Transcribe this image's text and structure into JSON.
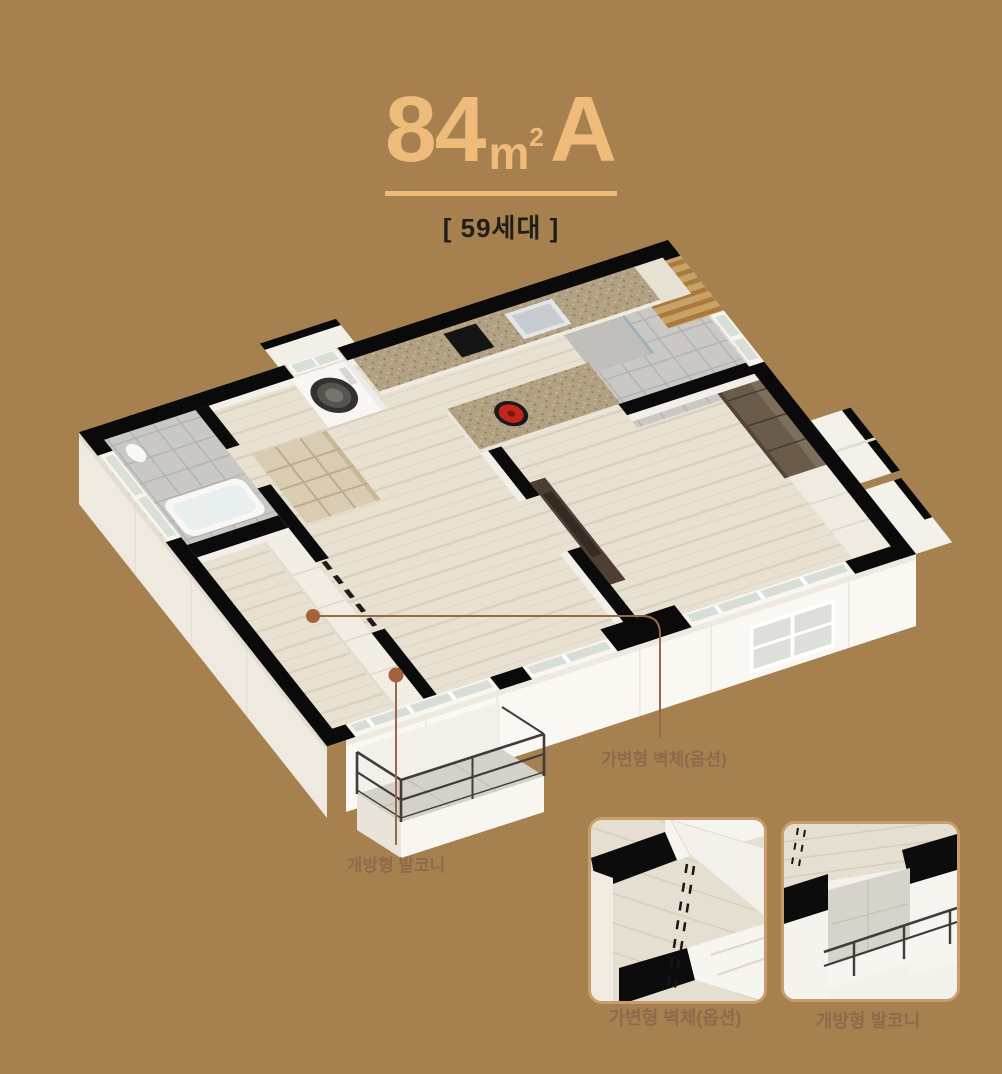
{
  "title": {
    "area": "84",
    "unit": "m",
    "sup": "2",
    "type": "A"
  },
  "households": "[ 59세대 ]",
  "callouts": {
    "wall": "가변형 벽체(옵션)",
    "balcony": "개방형 발코니"
  },
  "insets": [
    {
      "caption": "가변형 벽체(옵션)"
    },
    {
      "caption": "개방형 발코니"
    }
  ],
  "colors": {
    "background": "#A6814F",
    "accent_gold": "#EFBB7B",
    "dark_text": "#201D18",
    "label_brown": "#8D6A4B",
    "leader_line": "#9B6847",
    "leader_dot": "#A3613C",
    "wall_black": "#0A0A0A",
    "wood_floor": "#E8E1D2",
    "inset_border": "#C79E69"
  }
}
